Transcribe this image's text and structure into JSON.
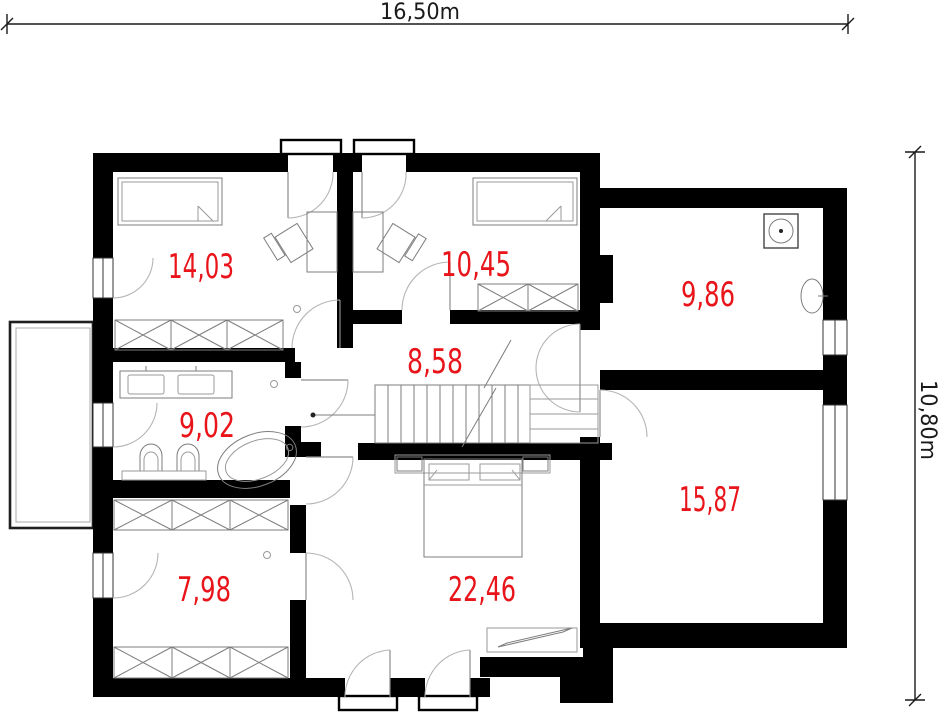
{
  "plan": {
    "type": "floor-plan",
    "floor_outer_width_label": "16,50m",
    "floor_outer_height_label": "10,80m"
  },
  "rooms": [
    {
      "area": "14,03"
    },
    {
      "area": "10,45"
    },
    {
      "area": "9,86"
    },
    {
      "area": "8,58"
    },
    {
      "area": "9,02"
    },
    {
      "area": "15,87"
    },
    {
      "area": "7,98"
    },
    {
      "area": "22,46"
    }
  ],
  "colors": {
    "room_label": "#e8141a",
    "wall": "#000000",
    "dimension": "#1a1a1a"
  }
}
